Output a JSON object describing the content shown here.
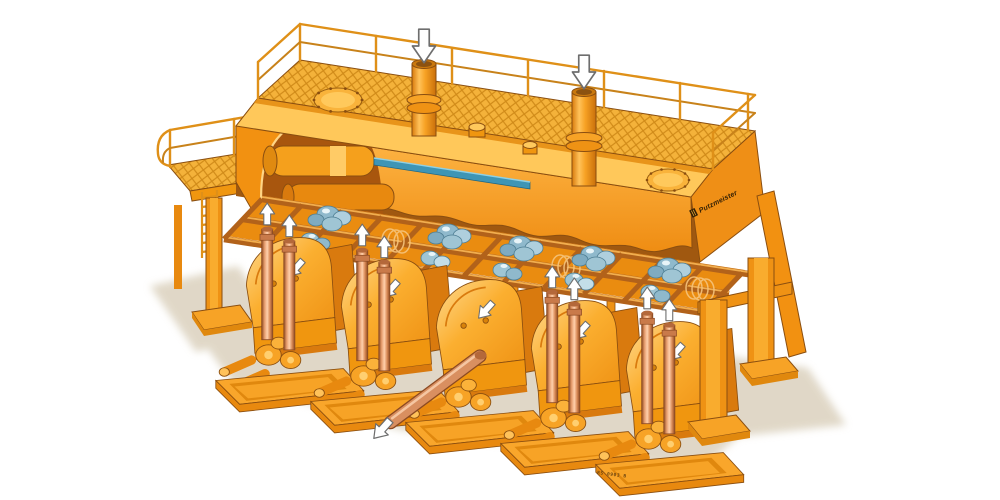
{
  "illustration": {
    "subject": "isometric cutaway illustration of a five-cylinder high-density solids piston pump station with feed platform",
    "background_color": "#ffffff",
    "branding": {
      "wordmark": "Putzmeister"
    },
    "markings": {
      "sled_code": "RS 0903 B"
    },
    "counts": {
      "pump_units": 5,
      "feed_inlet_pipes": 2,
      "manhole_covers": 2,
      "outlet_standpipes": 8,
      "support_legs": 4,
      "rock_clusters": 10
    },
    "flow_arrows": {
      "feed_inlet": {
        "count": 2,
        "direction": "down",
        "style": "white outlined arrow"
      },
      "standpipe_outlet": {
        "count": 8,
        "direction": "up",
        "style": "white outlined arrow"
      },
      "housing_flow": {
        "count": 5,
        "direction": "down-left",
        "style": "white arrow"
      },
      "discharge_line": {
        "count": 1,
        "direction": "down-left",
        "style": "white outlined arrow"
      }
    },
    "palette": {
      "orange_main": "#FFAB2E",
      "orange_light": "#FFC95C",
      "orange_mid": "#F29111",
      "orange_dark": "#D97A0E",
      "orange_deep": "#A8560E",
      "outline_brown": "#8A4E10",
      "copper_pipe": "#DE9066",
      "rock_blue": "#9BC3D4",
      "piston_rod_teal": "#3E95B5",
      "shadow_beige": "#DBD1BE",
      "arrow_white": "#FFFFFF"
    }
  }
}
